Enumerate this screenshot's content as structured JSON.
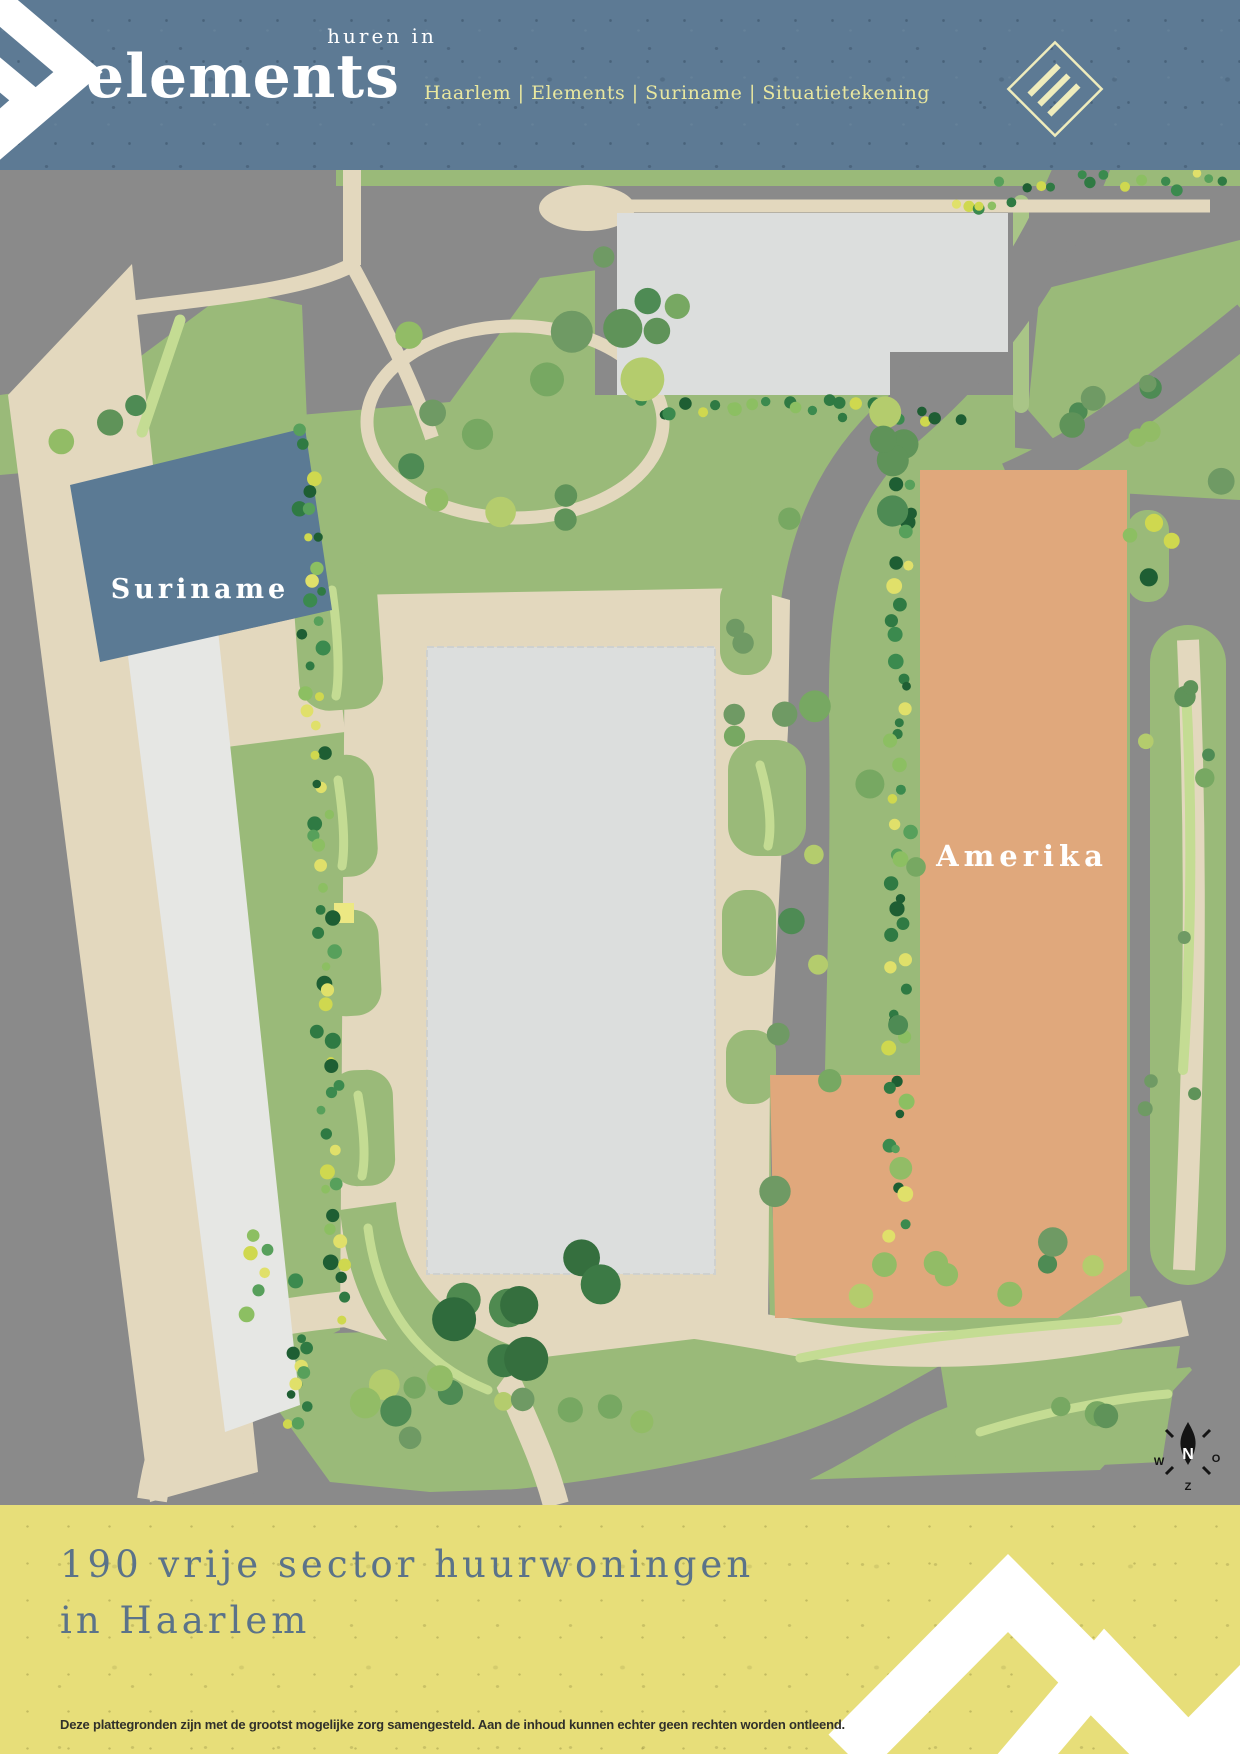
{
  "header": {
    "tagline": "huren in",
    "brand": "elements",
    "breadcrumb": "Haarlem | Elements | Suriname | Situatietekening"
  },
  "map": {
    "building_labels": {
      "suriname": "Suriname",
      "amerika": "Amerika"
    },
    "compass": {
      "north": "N",
      "east": "O",
      "south": "Z",
      "west": "W"
    }
  },
  "footer": {
    "headline_line1": "190 vrije sector huurwoningen",
    "headline_line2": "in Haarlem",
    "disclaimer": "Deze plattegronden zijn met de grootst mogelijke zorg samengesteld. Aan de inhoud kunnen echter geen rechten worden ontleend."
  },
  "colors": {
    "header_bg": "#5d7a94",
    "footer_bg": "#e7de79",
    "road_gray": "#8a8a8a",
    "grass_green": "#9aba79",
    "grass_light": "#a9c587",
    "accent_green": "#c4dc93",
    "path_beige": "#e3d8be",
    "building_gray": "#dcdedd",
    "building_white": "#e6e7e4",
    "suriname_blue": "#5b7a94",
    "amerika_orange": "#e0a87c",
    "headline_slate": "#5b7389",
    "breadcrumb_yellow": "#e9e79f",
    "logo_cream": "#efecbc",
    "tree_dark": "#1e5e33",
    "tree_mid": "#57a05b",
    "tree_light": "#b4cc6d"
  }
}
